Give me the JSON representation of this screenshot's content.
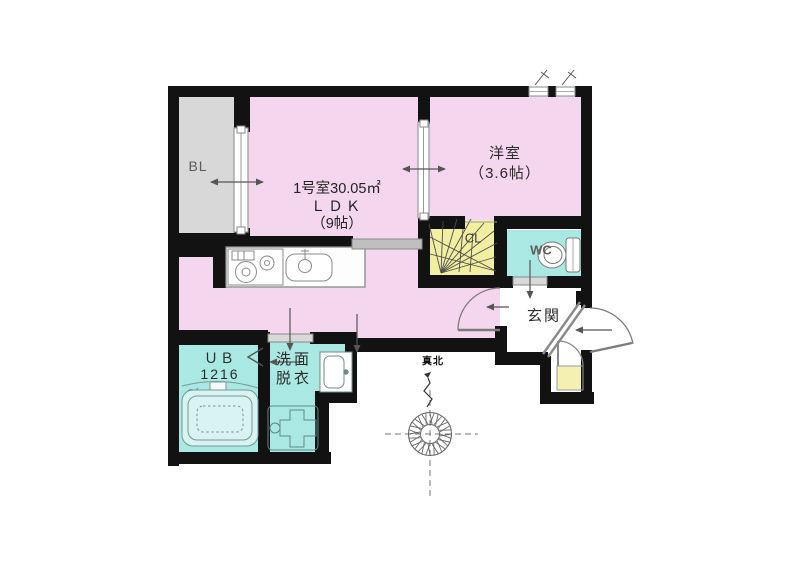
{
  "plan_title": "apartment-floor-plan",
  "rooms": {
    "balcony": {
      "label": "BL"
    },
    "ldk": {
      "line1": "1号室30.05㎡",
      "line2": "ＬＤＫ",
      "line3": "（9帖）"
    },
    "western": {
      "line1": "洋室",
      "line2": "（3.6帖）"
    },
    "closet": {
      "label": "CL"
    },
    "toilet": {
      "label": "WC"
    },
    "entrance": {
      "label": "玄関"
    },
    "bath": {
      "line1": "ＵＢ",
      "line2": "1216"
    },
    "washroom": {
      "line1": "洗面",
      "line2": "脱衣"
    }
  },
  "compass": {
    "north_label": "真北"
  },
  "fixtures": [
    "kitchen-stove",
    "kitchen-sink",
    "range-cabinet",
    "bathtub",
    "washing-machine-pan",
    "vanity",
    "toilet",
    "compass",
    "sliding-window",
    "entry-door",
    "closet-fan",
    "shoe-cabinet"
  ],
  "colors": {
    "room_pink": "#f4d7ef",
    "balcony_gray": "#d8d8d8",
    "closet_yellow": "#f3efa2",
    "wet_cyan": "#a9e8e3",
    "shoe_yellow": "#f4f0b2",
    "wall_black": "#121212",
    "fixture_gray": "#7b7b7b"
  }
}
